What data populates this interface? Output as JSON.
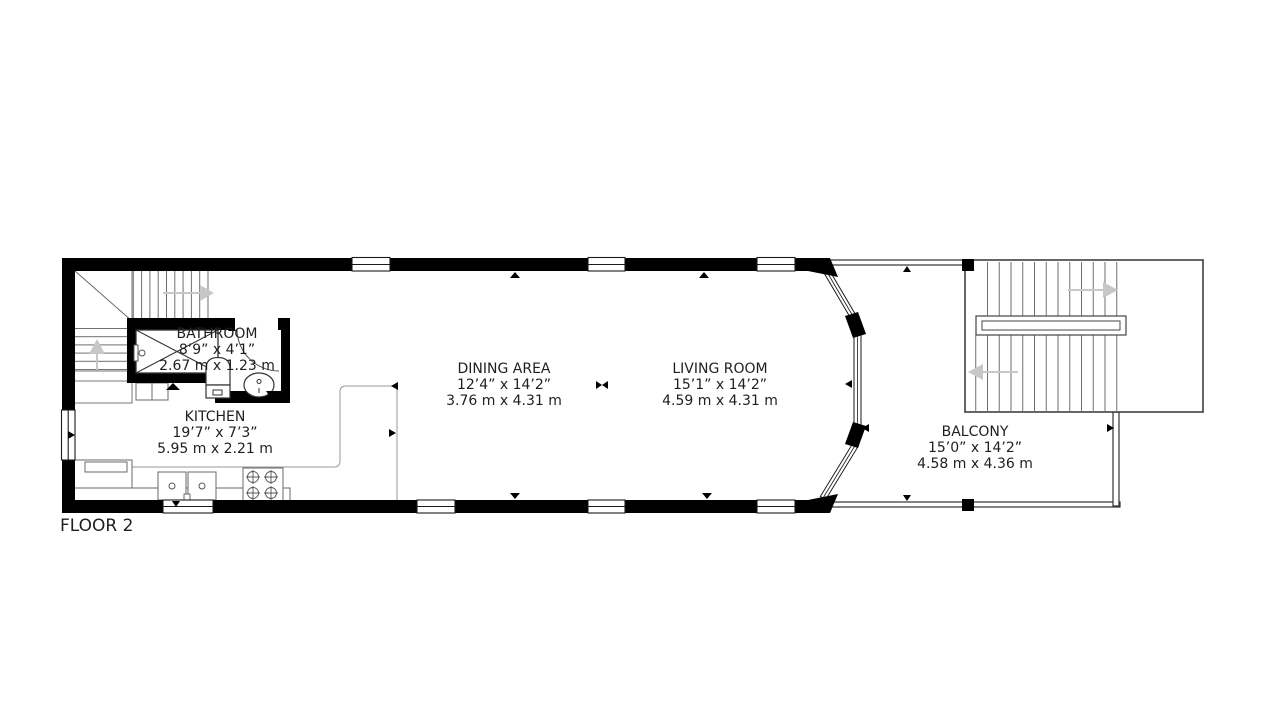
{
  "floor_label": "FLOOR 2",
  "rooms": [
    {
      "id": "bathroom",
      "name": "BATHROOM",
      "imperial": "8’9” x 4’1”",
      "metric": "2.67 m x 1.23 m"
    },
    {
      "id": "kitchen",
      "name": "KITCHEN",
      "imperial": "19’7” x 7’3”",
      "metric": "5.95 m x 2.21 m"
    },
    {
      "id": "dining-area",
      "name": "DINING AREA",
      "imperial": "12’4” x 14’2”",
      "metric": "3.76 m x 4.31 m"
    },
    {
      "id": "living-room",
      "name": "LIVING ROOM",
      "imperial": "15’1” x 14’2”",
      "metric": "4.59 m x 4.31 m"
    },
    {
      "id": "balcony",
      "name": "BALCONY",
      "imperial": "15’0” x 14’2”",
      "metric": "4.58 m x 4.36 m"
    }
  ],
  "colors": {
    "wall": "#000000",
    "thin_wall_outline": "#333333",
    "zone_line": "#999999",
    "stair_tread": "#6e6e6e",
    "direction_arrow": "#c7c7c7",
    "fixture_outline": "#333333",
    "text": "#1f1f1f",
    "background": "#ffffff"
  }
}
